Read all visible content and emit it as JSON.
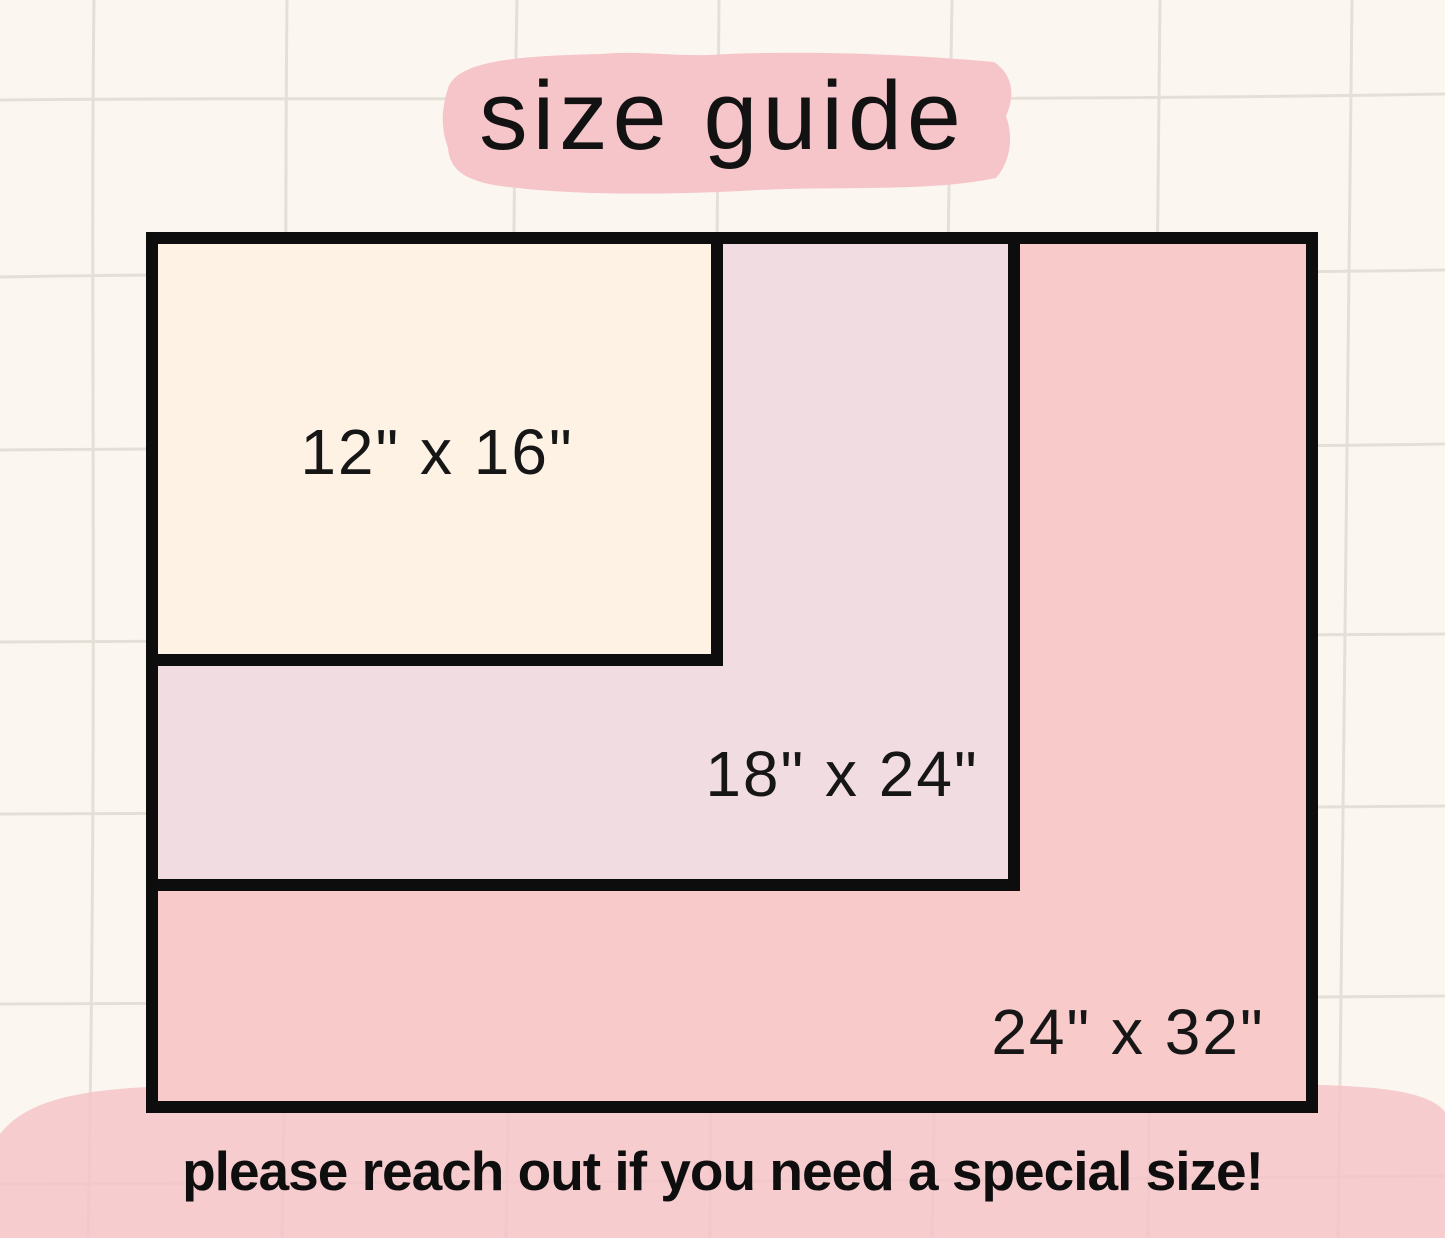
{
  "title": "size guide",
  "footer_note": "please reach out if you need a special size!",
  "sizes": [
    {
      "label": "12\" x 16\"",
      "width_inches": 16,
      "height_inches": 12,
      "fill": "#fdf2e3"
    },
    {
      "label": "18\" x 24\"",
      "width_inches": 24,
      "height_inches": 18,
      "fill": "#f1dce1"
    },
    {
      "label": "24\" x 32\"",
      "width_inches": 32,
      "height_inches": 24,
      "fill": "#f8caca"
    }
  ],
  "colors": {
    "background": "#fbf6f0",
    "grid_line": "#e4e0d8",
    "rect_outline": "#0d0d0d",
    "title_highlight": "#f5c5ca",
    "footer_blob": "#f6c3c8",
    "text": "#121212"
  }
}
